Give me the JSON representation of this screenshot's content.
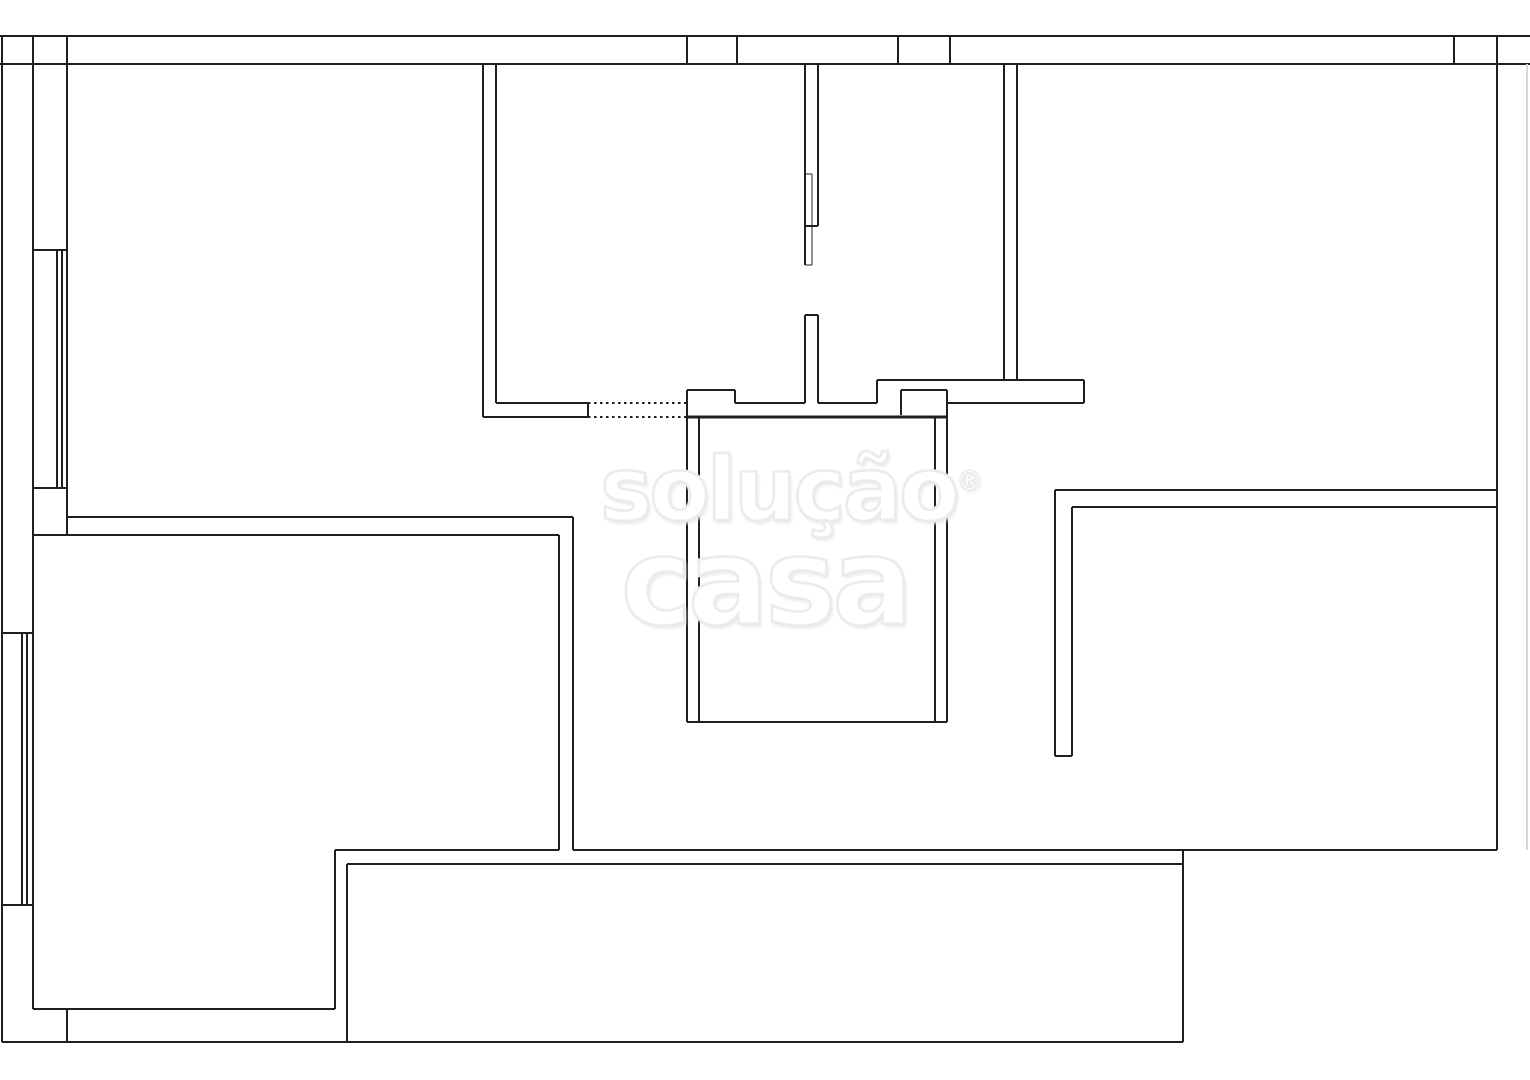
{
  "watermark": {
    "line1": "solução",
    "registered_mark": "®",
    "line2": "casa"
  },
  "plan": {
    "canvas": {
      "width": 1530,
      "height": 1080,
      "background": "#ffffff"
    },
    "colors": {
      "wall": "#1f1f1f",
      "faint_edge": "#d8d8d8"
    },
    "segments": [
      [
        0,
        36,
        1530,
        36
      ],
      [
        0,
        64,
        1530,
        64
      ],
      [
        2,
        36,
        2,
        1042
      ],
      [
        33,
        36,
        33,
        1009
      ],
      [
        67,
        36,
        67,
        535
      ],
      [
        687,
        36,
        687,
        64
      ],
      [
        737,
        36,
        737,
        64
      ],
      [
        898,
        36,
        898,
        64
      ],
      [
        950,
        36,
        950,
        64
      ],
      [
        1454,
        36,
        1454,
        64
      ],
      [
        1497,
        36,
        1497,
        850
      ],
      [
        1527,
        64,
        1527,
        850,
        "faint"
      ],
      [
        33,
        250,
        67,
        250
      ],
      [
        33,
        488,
        67,
        488
      ],
      [
        57,
        250,
        57,
        488
      ],
      [
        62,
        250,
        62,
        488
      ],
      [
        2,
        633,
        33,
        633
      ],
      [
        2,
        905,
        33,
        905
      ],
      [
        22,
        633,
        22,
        905
      ],
      [
        27,
        633,
        27,
        905
      ],
      [
        67,
        517,
        573,
        517
      ],
      [
        33,
        535,
        559,
        535
      ],
      [
        559,
        535,
        559,
        850
      ],
      [
        573,
        517,
        573,
        850
      ],
      [
        33,
        1009,
        335,
        1009
      ],
      [
        335,
        850,
        335,
        1009
      ],
      [
        335,
        850,
        559,
        850
      ],
      [
        573,
        850,
        1497,
        850
      ],
      [
        347,
        864,
        1183,
        864
      ],
      [
        347,
        864,
        347,
        1042
      ],
      [
        2,
        1042,
        1183,
        1042
      ],
      [
        67,
        1009,
        67,
        1042
      ],
      [
        1183,
        850,
        1183,
        1042
      ],
      [
        483,
        64,
        483,
        417
      ],
      [
        496,
        64,
        496,
        403
      ],
      [
        496,
        403,
        588,
        403
      ],
      [
        483,
        417,
        588,
        417
      ],
      [
        588,
        403,
        588,
        417
      ],
      [
        588,
        403,
        687,
        403,
        "dotted"
      ],
      [
        588,
        417,
        687,
        417,
        "dotted"
      ],
      [
        687,
        390,
        735,
        390
      ],
      [
        687,
        390,
        687,
        417
      ],
      [
        735,
        390,
        735,
        403
      ],
      [
        735,
        403,
        805,
        403
      ],
      [
        818,
        403,
        877,
        403
      ],
      [
        687,
        417,
        947,
        417,
        "thick"
      ],
      [
        805,
        64,
        805,
        265
      ],
      [
        818,
        64,
        818,
        226
      ],
      [
        812,
        174,
        812,
        265,
        "thin"
      ],
      [
        805,
        174,
        812,
        174,
        "thin"
      ],
      [
        805,
        226,
        818,
        226
      ],
      [
        805,
        265,
        812,
        265,
        "thin"
      ],
      [
        805,
        315,
        805,
        403
      ],
      [
        818,
        315,
        818,
        403
      ],
      [
        805,
        315,
        818,
        315
      ],
      [
        877,
        380,
        1084,
        380
      ],
      [
        877,
        380,
        877,
        403
      ],
      [
        1084,
        380,
        1084,
        403
      ],
      [
        947,
        403,
        1084,
        403
      ],
      [
        901,
        390,
        947,
        390
      ],
      [
        901,
        390,
        901,
        415
      ],
      [
        947,
        390,
        947,
        417
      ],
      [
        687,
        417,
        687,
        722
      ],
      [
        699,
        417,
        699,
        722
      ],
      [
        935,
        417,
        935,
        722
      ],
      [
        947,
        417,
        947,
        722
      ],
      [
        687,
        722,
        947,
        722
      ],
      [
        1004,
        64,
        1004,
        380
      ],
      [
        1017,
        64,
        1017,
        380
      ],
      [
        1055,
        490,
        1497,
        490
      ],
      [
        1072,
        507,
        1497,
        507
      ],
      [
        1055,
        490,
        1055,
        756
      ],
      [
        1072,
        507,
        1072,
        756
      ],
      [
        1055,
        756,
        1072,
        756
      ]
    ]
  }
}
